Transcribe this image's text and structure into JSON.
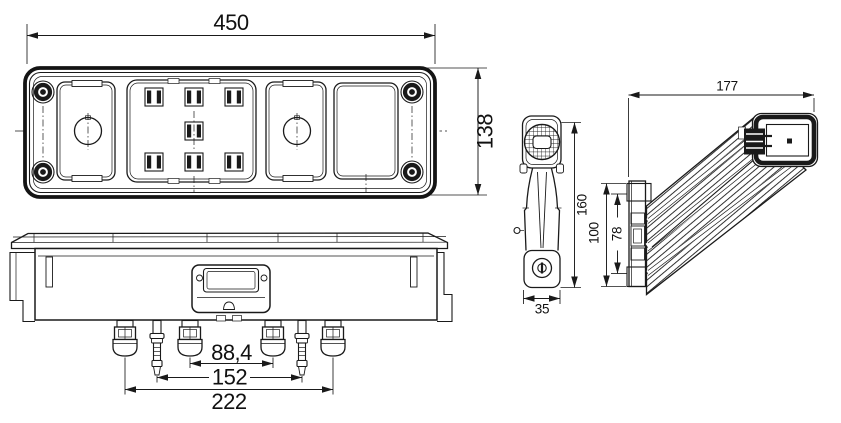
{
  "style": {
    "background": "#ffffff",
    "line_color": "#1a1a1a",
    "text_color": "#111111"
  },
  "views": {
    "rear_lamp_front": {
      "dims": {
        "width": "450",
        "height": "138"
      }
    },
    "rear_lamp_bottom": {
      "dims": {
        "stud_spacing_inner": "88,4",
        "stud_spacing_middle": "152",
        "stud_spacing_outer": "222"
      }
    },
    "marker_lamp_front": {
      "dims": {
        "height": "160",
        "foot_width": "35"
      }
    },
    "marker_lamp_side": {
      "dims": {
        "depth": "177",
        "base_height_outer": "100",
        "base_height_inner": "78"
      }
    }
  }
}
